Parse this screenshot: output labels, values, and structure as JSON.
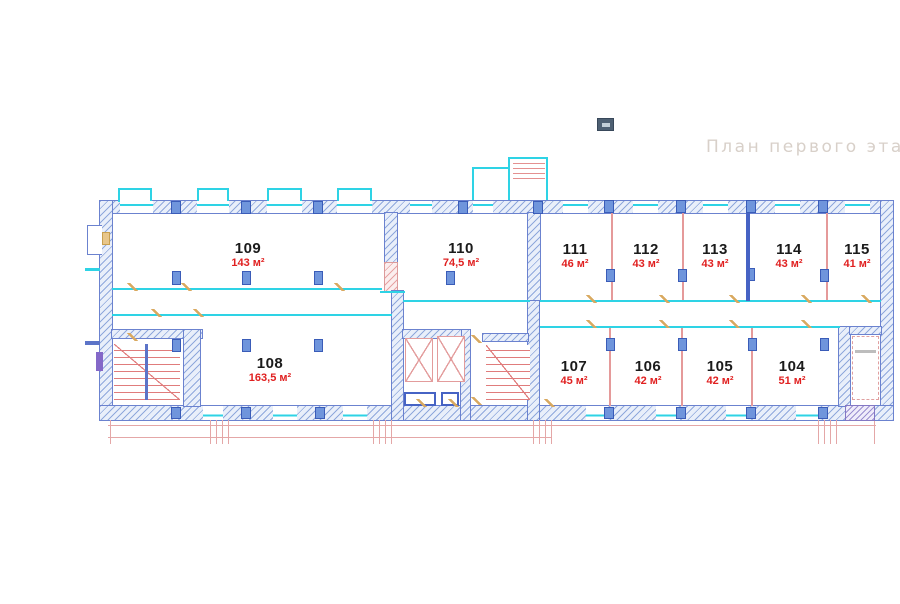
{
  "title": "План первого этажа",
  "rooms": [
    {
      "number": "109",
      "area": "143 м²"
    },
    {
      "number": "110",
      "area": "74,5 м²"
    },
    {
      "number": "111",
      "area": "46 м²"
    },
    {
      "number": "112",
      "area": "43 м²"
    },
    {
      "number": "113",
      "area": "43 м²"
    },
    {
      "number": "114",
      "area": "43 м²"
    },
    {
      "number": "115",
      "area": "41 м²"
    },
    {
      "number": "108",
      "area": "163,5 м²"
    },
    {
      "number": "107",
      "area": "45 м²"
    },
    {
      "number": "106",
      "area": "42 м²"
    },
    {
      "number": "105",
      "area": "42 м²"
    },
    {
      "number": "104",
      "area": "51 м²"
    }
  ],
  "icons": [
    {
      "name": "panel-toggle-icon"
    }
  ],
  "colors": {
    "wall_outline": "#6b82cf",
    "wall_hatch": "#8fa8dc",
    "window_cyan": "#2ed3e5",
    "partition_red": "#e59a9a",
    "partition_blue": "#4663c4",
    "column_blue": "#6f95dc",
    "room_number_text": "#1b1b1b",
    "room_area_text": "#e02020",
    "title_text": "#d8d0c9",
    "door_tan": "#d9a95f",
    "dimension_red": "#e4a7a7",
    "stairs_red": "#e07c7c",
    "icon_bg": "#4e6073"
  }
}
